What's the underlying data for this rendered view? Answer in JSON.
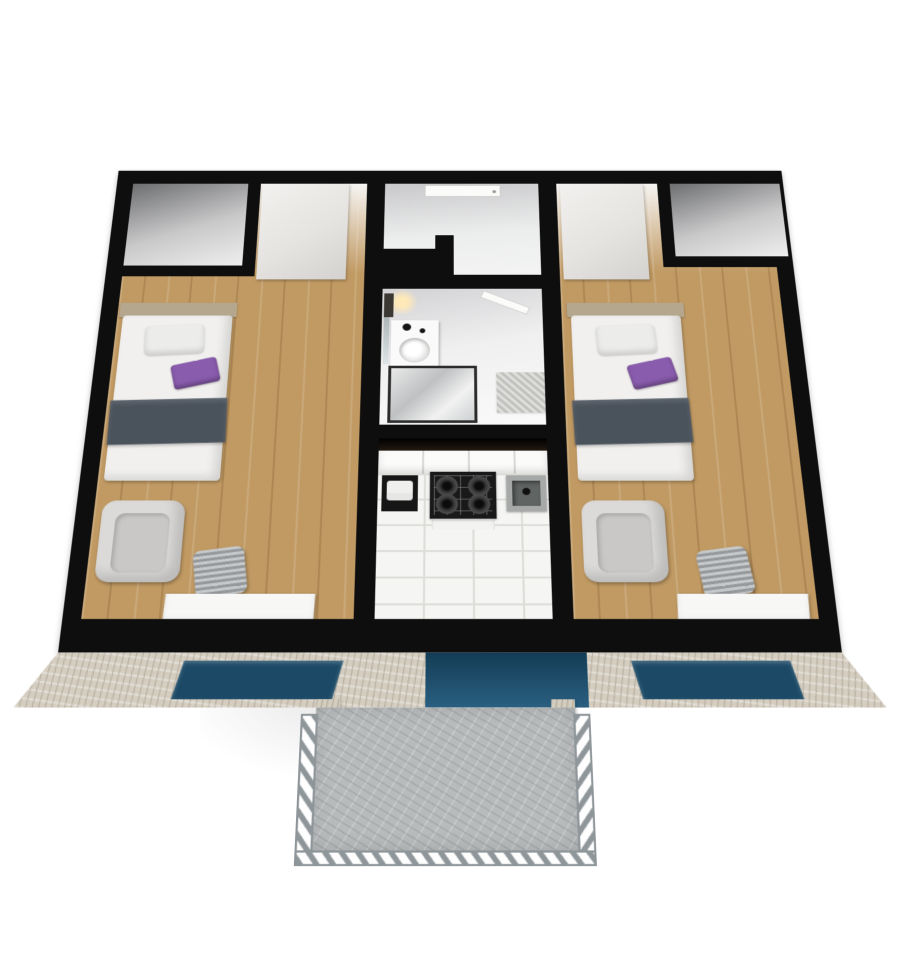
{
  "scene": {
    "type": "3d-floor-plan-render",
    "description": "Top-down 3D rendered floor plan of an apartment with black walls, two bedrooms, central entry hall, bathroom, kitchen and a front balcony",
    "background": "#ffffff"
  },
  "rooms": [
    {
      "name": "closet-top-left",
      "floor": "white"
    },
    {
      "name": "bedroom-left",
      "floor": "wood",
      "furniture": [
        "wardrobe",
        "single-bed",
        "armchair",
        "chair",
        "desk"
      ]
    },
    {
      "name": "entry-hall",
      "floor": "white",
      "furniture": [
        "entrance-door"
      ]
    },
    {
      "name": "bathroom",
      "floor": "white",
      "furniture": [
        "vanity-sink",
        "mirror",
        "towel",
        "wall-lamp",
        "shower",
        "bath-mat",
        "door"
      ]
    },
    {
      "name": "kitchen",
      "floor": "white-tile",
      "furniture": [
        "upper-cabinets",
        "appliance",
        "gas-stove",
        "oven",
        "sink"
      ]
    },
    {
      "name": "bedroom-right",
      "floor": "wood",
      "furniture": [
        "wardrobe",
        "single-bed",
        "armchair",
        "chair",
        "desk"
      ]
    },
    {
      "name": "closet-top-right",
      "floor": "white"
    },
    {
      "name": "balcony",
      "floor": "concrete",
      "furniture": [
        "railing"
      ]
    }
  ],
  "exterior": {
    "facade": "light-stone",
    "windows": [
      "window-left",
      "balcony-glass-door",
      "window-right"
    ]
  },
  "colors": {
    "wall": "#0e0e0e",
    "wood": "#c19a63",
    "tile-floor": "#f5f5f3",
    "tile-line": "#dcdcd8",
    "hall-floor": "#eceded",
    "wardrobe": "#e6e4e1",
    "bed-sheet": "#f1f0ee",
    "blanket": "#4a525c",
    "pillow": "#ececea",
    "pillow-accent": "#8a5cae",
    "headboard": "#b5a78d",
    "armchair": "#dbdad8",
    "armchair-shadow": "#c9c8c6",
    "chair": "#a9adb0",
    "desk": "#f7f7f6",
    "vanity": "#fafafa",
    "basin": "#dededd",
    "mat": "#cbcbc8",
    "towel": "#3b3833",
    "lamp-glow": "#ffe9b8",
    "shower-frame": "#2b2b2b",
    "stove": "#191919",
    "burner": "#3f3f3f",
    "oven": "#f2f2f1",
    "appliance": "#161616",
    "sink-outer": "#a7a9a8",
    "sink-basin": "#606462",
    "cabinet": "#fbfbfa",
    "cabinet-line": "#d8d8d4",
    "dark-band": "#241a11",
    "facade": "#d4cdc0",
    "glass": "#1c4a66",
    "glass-door": "#2a5f80",
    "concrete": "#b8bbbc",
    "railing": "#8f969a"
  }
}
